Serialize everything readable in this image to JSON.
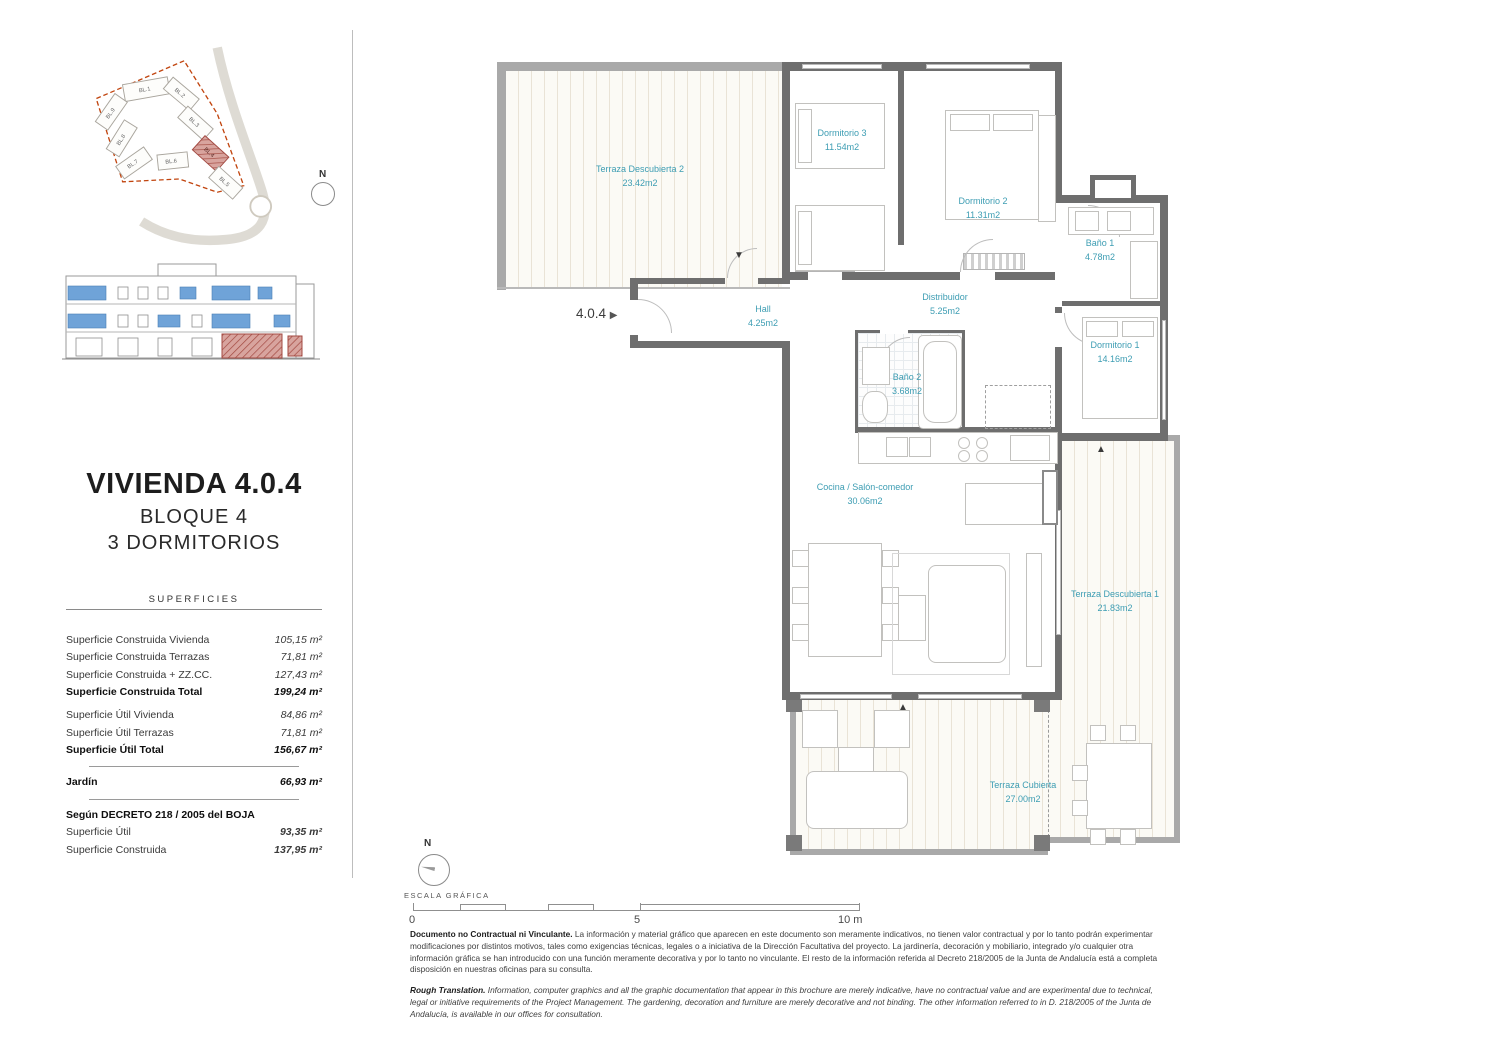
{
  "sidebar": {
    "title": "VIVIENDA 4.0.4",
    "subtitle1": "BLOQUE 4",
    "subtitle2": "3 DORMITORIOS",
    "superficies": {
      "heading": "SUPERFICIES",
      "rows": [
        {
          "label": "Superficie Construida Vivienda",
          "value": "105,15 m²"
        },
        {
          "label": "Superficie Construida Terrazas",
          "value": "71,81 m²"
        },
        {
          "label": "Superficie Construida + ZZ.CC.",
          "value": "127,43 m²"
        },
        {
          "label": "Superficie Construida Total",
          "value": "199,24 m²"
        },
        {
          "label": "Superficie Útil Vivienda",
          "value": "84,86 m²"
        },
        {
          "label": "Superficie Útil Terrazas",
          "value": "71,81 m²"
        },
        {
          "label": "Superficie Útil Total",
          "value": "156,67 m²"
        },
        {
          "label": "Jardín",
          "value": "66,93 m²"
        }
      ],
      "decree": {
        "heading": "Según DECRETO 218 / 2005 del BOJA",
        "rows": [
          {
            "label": "Superficie Útil",
            "value": "93,35 m²"
          },
          {
            "label": "Superficie Construida",
            "value": "137,95 m²"
          }
        ]
      }
    }
  },
  "plan": {
    "unit_label": "4.0.4",
    "rooms": {
      "terraza_descubierta_2": {
        "name": "Terraza Descubierta 2",
        "area": "23.42m2"
      },
      "dormitorio_3": {
        "name": "Dormitorio 3",
        "area": "11.54m2"
      },
      "dormitorio_2": {
        "name": "Dormitorio 2",
        "area": "11.31m2"
      },
      "bano_1": {
        "name": "Baño 1",
        "area": "4.78m2"
      },
      "hall": {
        "name": "Hall",
        "area": "4.25m2"
      },
      "distribuidor": {
        "name": "Distribuidor",
        "area": "5.25m2"
      },
      "bano_2": {
        "name": "Baño 2",
        "area": "3.68m2"
      },
      "dormitorio_1": {
        "name": "Dormitorio 1",
        "area": "14.16m2"
      },
      "cocina_salon": {
        "name": "Cocina / Salón-comedor",
        "area": "30.06m2"
      },
      "terraza_descubierta_1": {
        "name": "Terraza Descubierta 1",
        "area": "21.83m2"
      },
      "terraza_cubierta": {
        "name": "Terraza Cubierta",
        "area": "27.00m2"
      }
    }
  },
  "site_plan": {
    "blocks": [
      "BL.1",
      "BL.2",
      "BL.3",
      "BL.4",
      "BL.5",
      "BL.6",
      "BL.7",
      "BL.8",
      "BL.9"
    ],
    "compass": "N"
  },
  "scale_bar": {
    "compass": "N",
    "label": "ESCALA GRÁFICA",
    "tick_start": "0",
    "tick_mid": "5",
    "tick_end": "10 m"
  },
  "disclaimer": {
    "es_title": "Documento no Contractual ni Vinculante.",
    "es_body": "La información y material gráfico que aparecen en este documento son meramente indicativos, no tienen valor contractual y por lo tanto podrán experimentar modificaciones por distintos motivos, tales como exigencias técnicas, legales o a iniciativa de la Dirección Facultativa del proyecto. La jardinería, decoración y mobiliario, integrado y/o cualquier otra información gráfica se han introducido con una función meramente decorativa y por lo tanto no vinculante. El resto de la información referida al Decreto 218/2005 de la Junta de Andalucía está a completa disposición en nuestras oficinas para su consulta.",
    "en_title": "Rough Translation.",
    "en_body": "Information, computer graphics and all the graphic documentation that appear in this brochure are merely indicative, have no contractual value and are experimental due to technical, legal or initiative requirements of the Project Management. The gardening, decoration and furniture are merely decorative and not binding. The other information referred to in D. 218/2005 of the Junta de Andalucía, is available in our offices for consultation."
  },
  "colors": {
    "room_label_teal": "#3d9db3",
    "highlight_red": "#b0534d",
    "window_blue": "#6fa3d8",
    "boundary_red": "#c1440e",
    "wall_gray": "#6e6e6e"
  }
}
